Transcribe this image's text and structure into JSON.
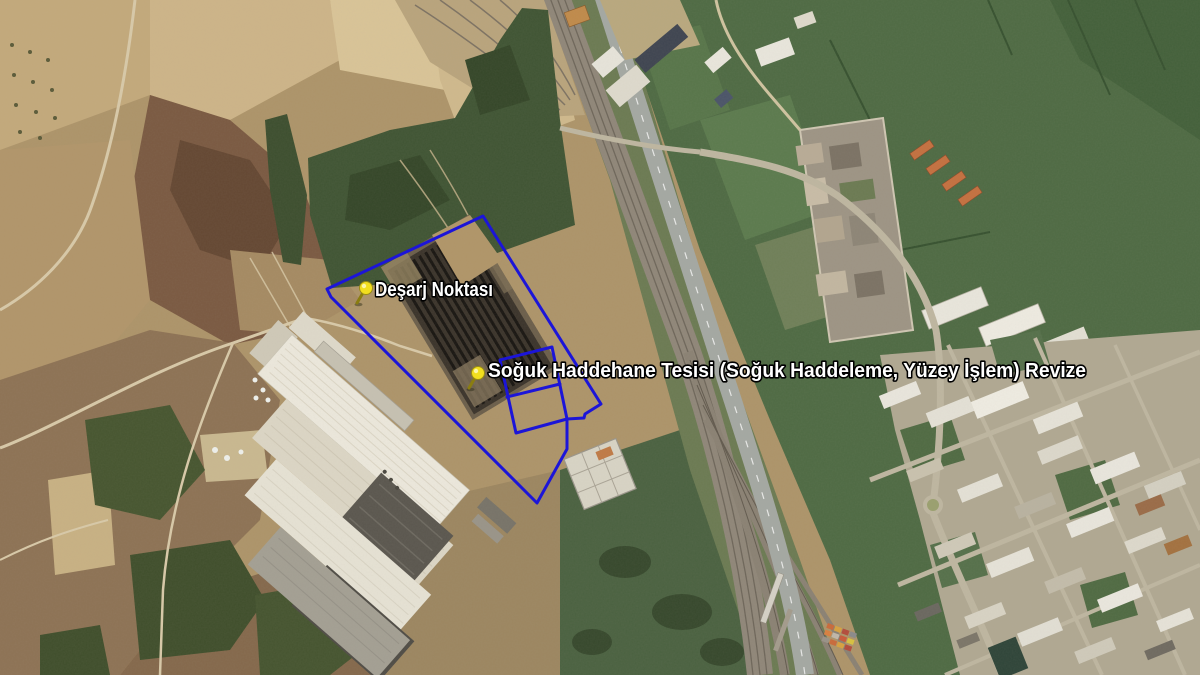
{
  "view": {
    "type": "satellite-imagery-with-placemarks",
    "width": 1200,
    "height": 675
  },
  "placemarks": [
    {
      "name": "Deşarj Noktası",
      "pin": {
        "icon": "yellow-pushpin",
        "color": "#f2df1e",
        "transform": "translate(357,303)"
      },
      "label": {
        "x": 375,
        "y": 296,
        "textLength": 118
      }
    },
    {
      "name": "Soğuk Haddehane Tesisi (Soğuk Haddeleme, Yüzey İşlem) Revize",
      "pin": {
        "icon": "yellow-pushpin",
        "color": "#f2df1e",
        "transform": "translate(469,388)"
      },
      "label": {
        "x": 488,
        "y": 377,
        "textLength": 598
      }
    }
  ],
  "site_boundary": {
    "color": "#1c15d8",
    "outer_path": "M 483 216 L 601 404 L 585 414 L 584 418 L 567 419 L 567 449 L 537 503 L 331 297 L 327 289 Z",
    "inner_ring_path": "M 500 360 L 552 347 L 567 419 L 516 433 Z",
    "inner_divider_path": "M 507 397 L 560 384"
  },
  "palette": {
    "boundary_blue": "#1c15d8",
    "pin_yellow": "#f2df1e",
    "farmland_tan": "#b0966b",
    "dark_field_brown": "#7a5941",
    "green_fields": "#4e6a43",
    "dark_trees": "#3c4e2e",
    "rail_corridor": "#8f8678",
    "highway_gray": "#a4a8a2",
    "roof_white": "#ece8dc",
    "roof_dark": "#4f4c45",
    "coil_yard_dark": "#3a332a",
    "district_ground": "#b0a892",
    "label_text": "#ffffff"
  }
}
